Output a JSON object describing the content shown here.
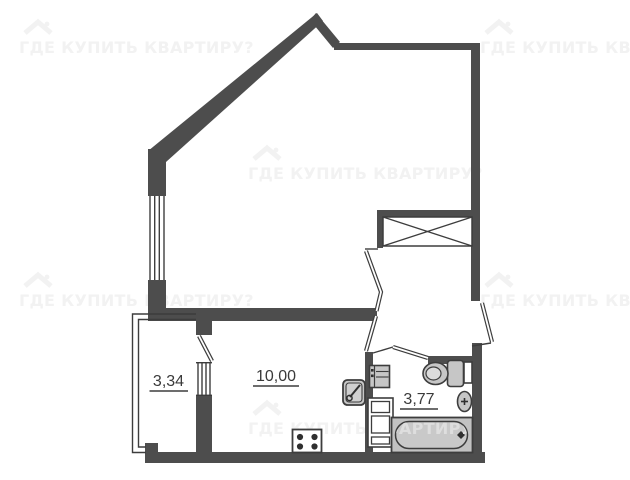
{
  "plan_title": "studio-apartment-floor-plan",
  "rooms": {
    "balcony": {
      "label": "3,34"
    },
    "kitchen": {
      "label": "10,00"
    },
    "bathroom": {
      "label": "3,77"
    }
  },
  "watermark": {
    "text": "ГДЕ КУПИТЬ КВАРТИРУ?",
    "icon": "house-roof-icon",
    "color": "#f2f2f2"
  },
  "fixtures": [
    "bathtub",
    "bathtub-drain",
    "toilet",
    "wash-basin",
    "kitchen-sink",
    "stove-4-burners",
    "washing-machine",
    "water-heater-cabinet",
    "ventilation-shaft",
    "wall-niche"
  ],
  "colors": {
    "background": "#ffffff",
    "wall": "#4d4d4d",
    "thin_line": "#3d3d3d",
    "fixture_fill": "#c6c6c6",
    "bathtub_fill": "#c2c2c2",
    "label_text": "#3a3a3a",
    "watermark": "#f2f2f2"
  }
}
